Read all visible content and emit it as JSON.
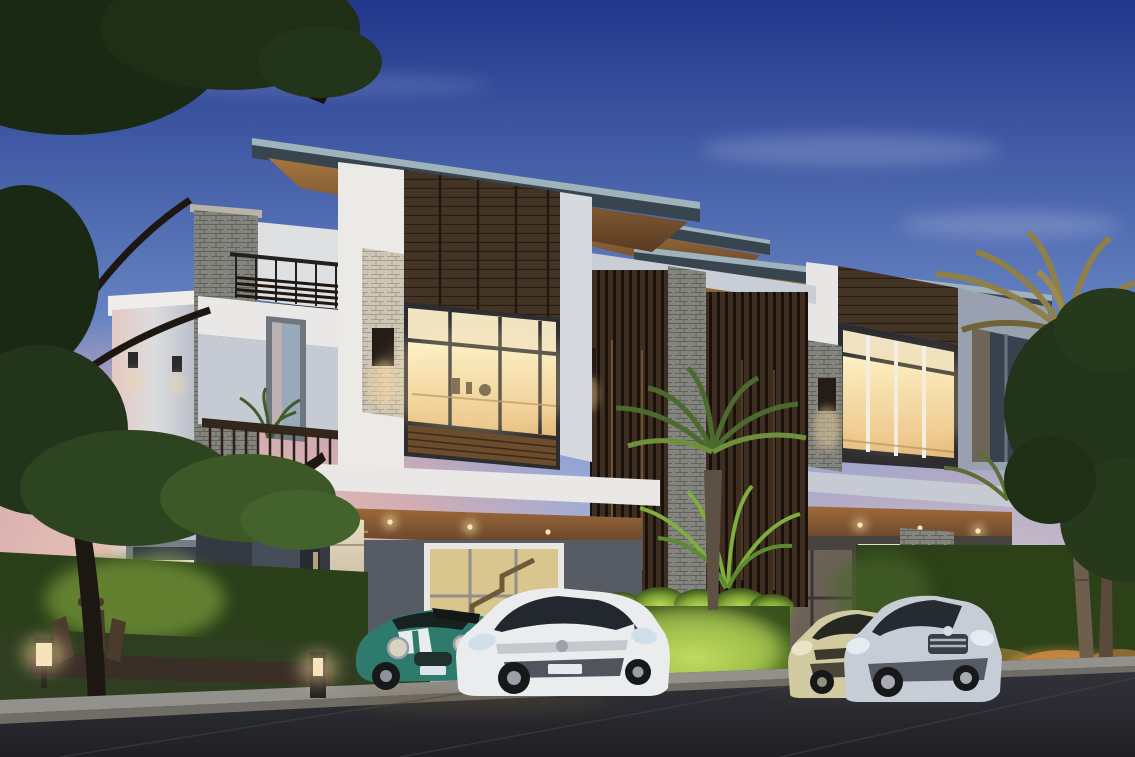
{
  "scene": {
    "type": "3d-architectural-rendering",
    "setting": "dusk",
    "subject": "Twin modern three-storey townhouses with glowing interiors, carports with four parked cars, landscaped hedges, palm trees, garden seating and a street in the foreground",
    "elements": [
      {
        "name": "dusk-sky",
        "color": "#22378b"
      },
      {
        "name": "sunset-glow-left",
        "color": "#e7aea6"
      },
      {
        "name": "left-corner-tree",
        "color": "#223419"
      },
      {
        "name": "townhouse-left-unit",
        "color": "#eceae7"
      },
      {
        "name": "townhouse-right-unit",
        "color": "#eceae7"
      },
      {
        "name": "rooftop-terrace-pergola",
        "color": "#3c2d20"
      },
      {
        "name": "wood-slat-privacy-screens",
        "color": "#3c2d20"
      },
      {
        "name": "stone-clad-pillars",
        "color": "#cdc5b6"
      },
      {
        "name": "warm-lit-windows",
        "color": "#f9e8b6"
      },
      {
        "name": "carport-left",
        "color": "#92683c"
      },
      {
        "name": "carport-right",
        "color": "#92683c"
      },
      {
        "name": "teal-mini-convertible",
        "color": "#2e7a6d"
      },
      {
        "name": "white-sedan",
        "color": "#eaecee"
      },
      {
        "name": "champagne-hatchback",
        "color": "#d2caa0"
      },
      {
        "name": "silver-sedan",
        "color": "#c7cdd7"
      },
      {
        "name": "illuminated-center-hedge",
        "color": "#9cc243"
      },
      {
        "name": "garden-deck-with-chairs",
        "color": "#3a2f26"
      },
      {
        "name": "garden-lanterns",
        "color": "#f7d89c"
      },
      {
        "name": "tall-palm-tree",
        "color": "#8f7f49"
      },
      {
        "name": "street-and-sidewalk",
        "color": "#2b2c32"
      }
    ]
  },
  "palette": {
    "sky_top": "#22378b",
    "sky_mid": "#7e97cc",
    "sky_low": "#bfc0da",
    "horizon_pink": "#e7aea6",
    "roof_fascia": "#38454e",
    "roof_edge": "#9fb3bd",
    "soffit_wood": "#92683c",
    "cladding_wood": "#443426",
    "wall_white": "#eceae7",
    "wall_shadow": "#b7bdc8",
    "stone_light": "#cdc5b6",
    "stone_grey": "#85857f",
    "window_warm": "#f9e8b6",
    "glass_cool": "#a9bccd",
    "frame_dark": "#2d2d30",
    "slat_wood": "#3c2d20",
    "hedge_dark": "#2a3f1a",
    "hedge_lit": "#9cc243",
    "grass": "#2f3e20",
    "palm_gold": "#8f7f49",
    "tree_green": "#223419",
    "asphalt": "#2b2c32",
    "curb_concrete": "#93918b",
    "car_teal": "#2e7a6d",
    "car_white": "#eaecee",
    "car_champagne": "#d2caa0",
    "car_silver": "#c7cdd7",
    "lamp_glow": "#f7d89c"
  }
}
